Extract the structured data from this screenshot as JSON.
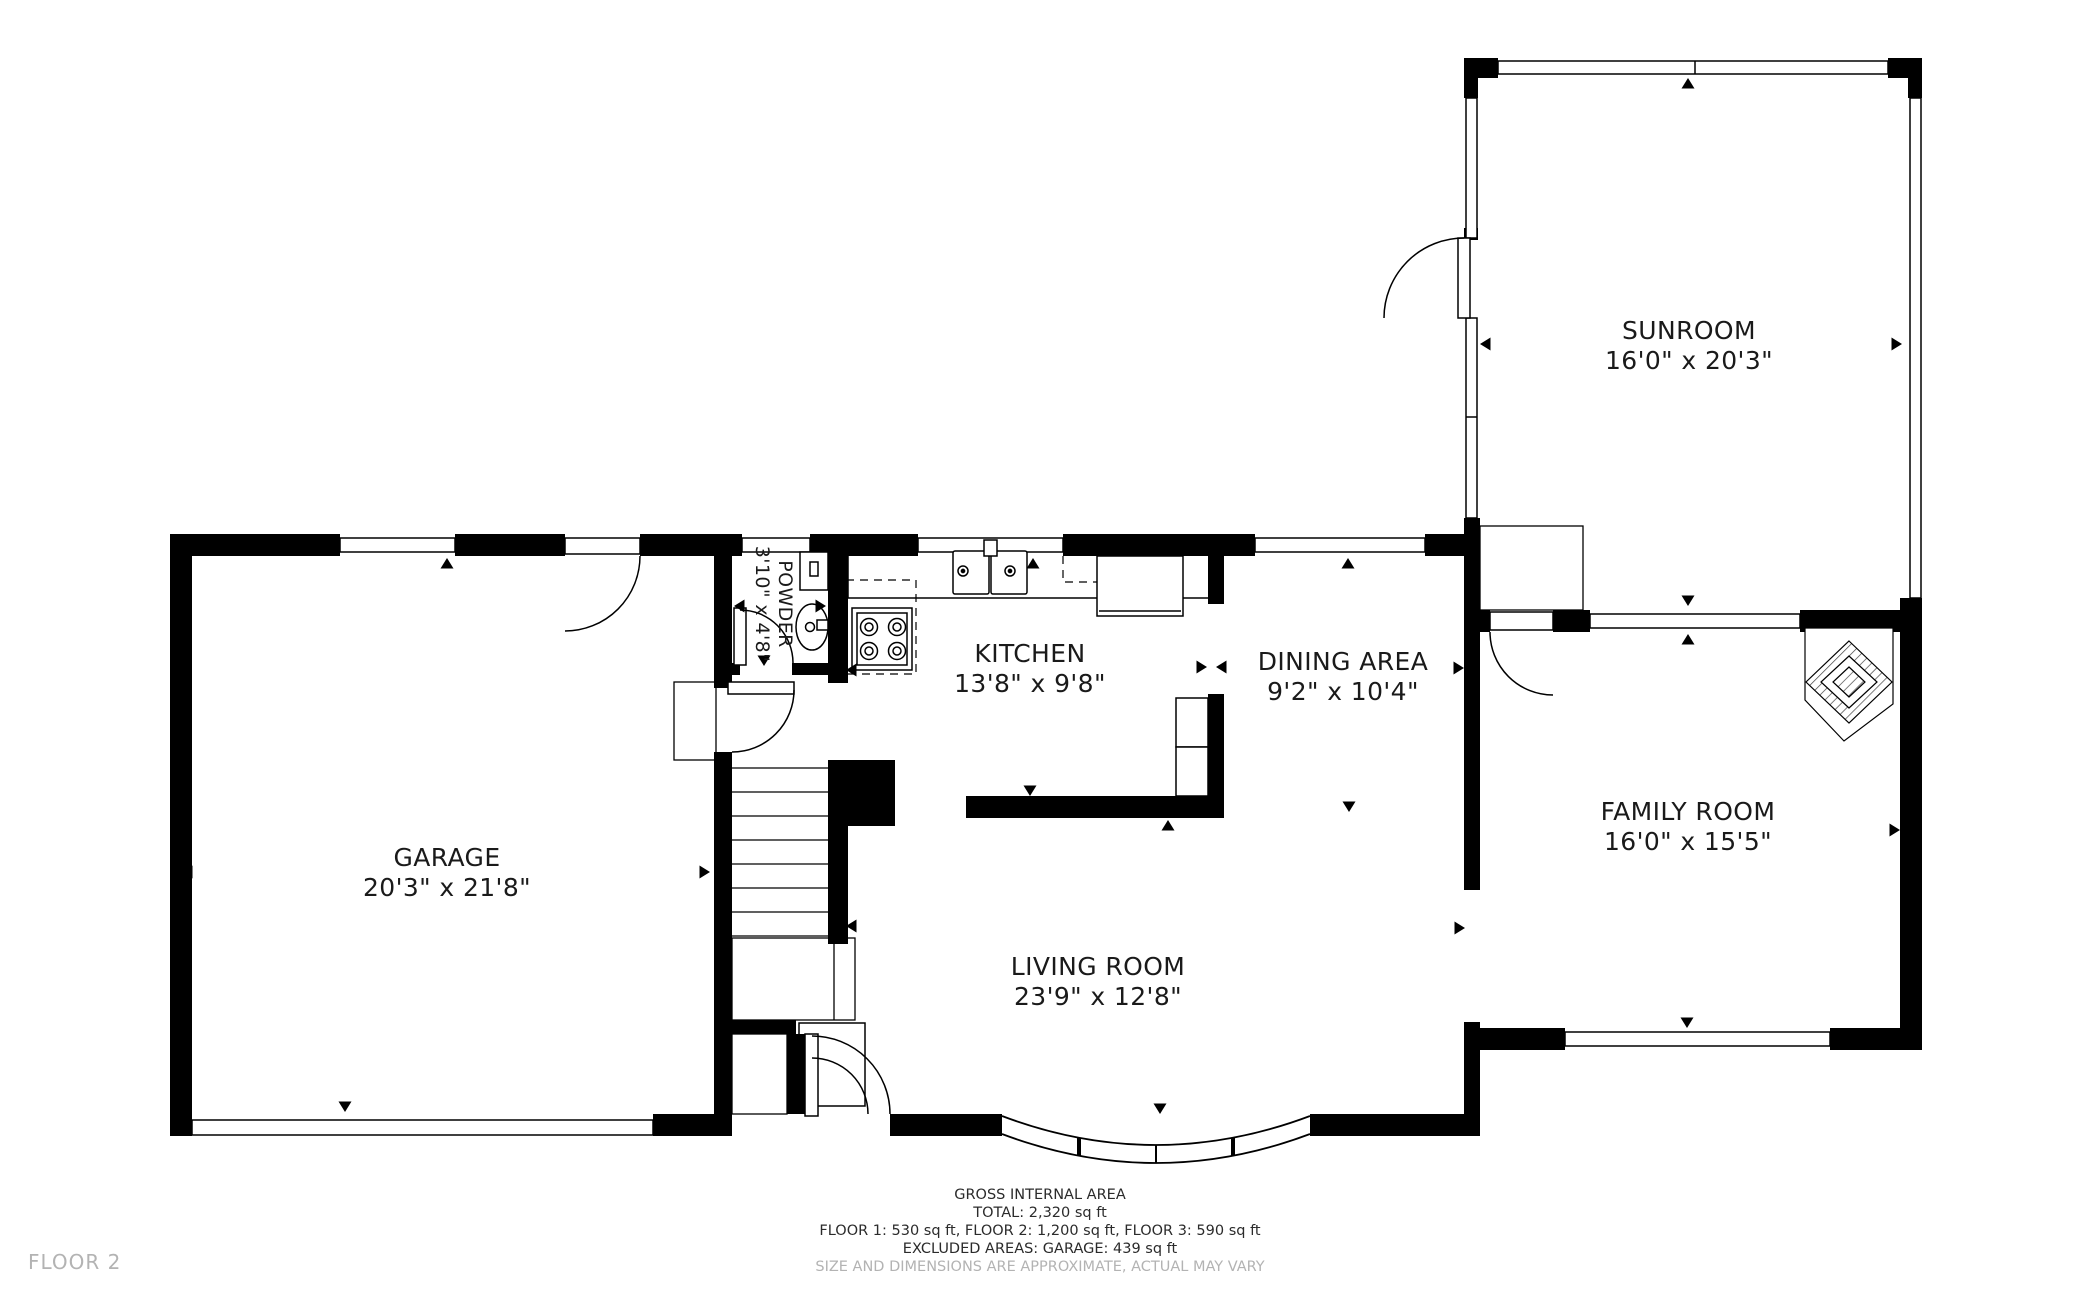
{
  "floor_plan": {
    "floor_label": "FLOOR 2",
    "rooms": [
      {
        "id": "sunroom",
        "name": "SUNROOM",
        "dims": "16'0\" x 20'3\""
      },
      {
        "id": "garage",
        "name": "GARAGE",
        "dims": "20'3\" x 21'8\""
      },
      {
        "id": "kitchen",
        "name": "KITCHEN",
        "dims": "13'8\" x 9'8\""
      },
      {
        "id": "dining",
        "name": "DINING AREA",
        "dims": "9'2\" x 10'4\""
      },
      {
        "id": "family",
        "name": "FAMILY ROOM",
        "dims": "16'0\" x 15'5\""
      },
      {
        "id": "living",
        "name": "LIVING ROOM",
        "dims": "23'9\" x 12'8\""
      },
      {
        "id": "powder",
        "name": "POWDER",
        "dims": "3'10\" x 4'8\""
      }
    ],
    "footer": {
      "title": "GROSS INTERNAL AREA",
      "total": "TOTAL: 2,320 sq ft",
      "floors": "FLOOR 1: 530 sq ft, FLOOR 2: 1,200 sq ft, FLOOR 3: 590 sq ft",
      "excluded": "EXCLUDED AREAS: GARAGE: 439 sq ft",
      "disclaimer": "SIZE AND DIMENSIONS ARE APPROXIMATE, ACTUAL MAY VARY"
    },
    "fixtures": [
      "stove",
      "double-sink",
      "refrigerator",
      "toilet",
      "washbasin",
      "corner-fireplace",
      "staircase",
      "bay-window",
      "garage-door"
    ],
    "colors": {
      "wall": "#000000",
      "text": "#1a1a1a",
      "muted_text": "#b3b3b3",
      "background": "#ffffff"
    }
  }
}
